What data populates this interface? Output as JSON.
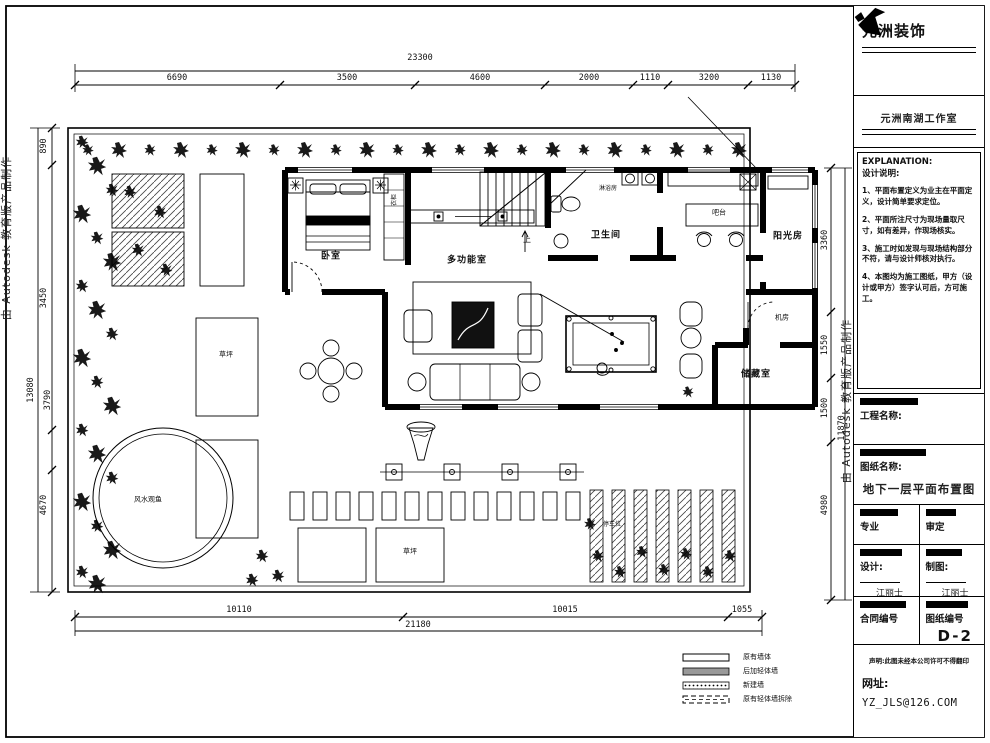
{
  "watermark": {
    "text": "由 Autodesk 教育版产品制作"
  },
  "brand": {
    "name": "元洲装饰",
    "studio": "元洲南湖工作室"
  },
  "explanation": {
    "title_en": "EXPLANATION:",
    "title_zh": "设计说明:",
    "notes": [
      "1、平面布置定义为业主在平面定义，设计简单要求定位。",
      "2、平面所注尺寸为现场量取尺寸，如有差异，作现场核实。",
      "3、施工时如发现与现场结构部分不符，请与设计师核对执行。",
      "4、本图均为施工图纸，甲方（设计或甲方）签字认可后，方可施工。"
    ]
  },
  "titleblock": {
    "project_label": "工程名称:",
    "drawing_label": "图纸名称:",
    "drawing_title": "地下一层平面布置图",
    "cell_major": "专业",
    "cell_approve": "审定",
    "design_label": "设计:",
    "design_sign": "江丽士",
    "draw_label": "制图:",
    "draw_sign": "江丽士",
    "contract_label": "合同编号",
    "sheet_label": "图纸编号",
    "sheet_no": "D-2",
    "disclaimer": "声明:此图未经本公司许可不得翻印",
    "website_label": "网址:",
    "email": "YZ_JLS@126.COM"
  },
  "dims": {
    "top": {
      "total": "23300",
      "segments": [
        "6690",
        "3500",
        "4600",
        "2000",
        "1110",
        "3200",
        "1130"
      ]
    },
    "left": {
      "total": "13080",
      "segments": [
        "890",
        "3450",
        "3790",
        "4670"
      ]
    },
    "right": {
      "total": "11870",
      "segments": [
        "3360",
        "1550",
        "1500",
        "4980"
      ]
    },
    "bottom": {
      "total": "21180",
      "segments": [
        "10110",
        "10015",
        "1055"
      ]
    }
  },
  "rooms": {
    "bedroom": "卧室",
    "multi": "多功能室",
    "bath": "卫生间",
    "shower": "淋浴房",
    "bar": "吧台",
    "sunroom": "阳光房",
    "machine": "机房",
    "storage": "储藏室",
    "closet": "衣柜",
    "up": "上",
    "lawn1": "草坪",
    "lawn2": "草坪",
    "pond": "风水观鱼",
    "parking": "停车位"
  },
  "legend": {
    "items": [
      "原有墙体",
      "后加轻体墙",
      "新建墙",
      "原有轻体墙拆除"
    ]
  }
}
